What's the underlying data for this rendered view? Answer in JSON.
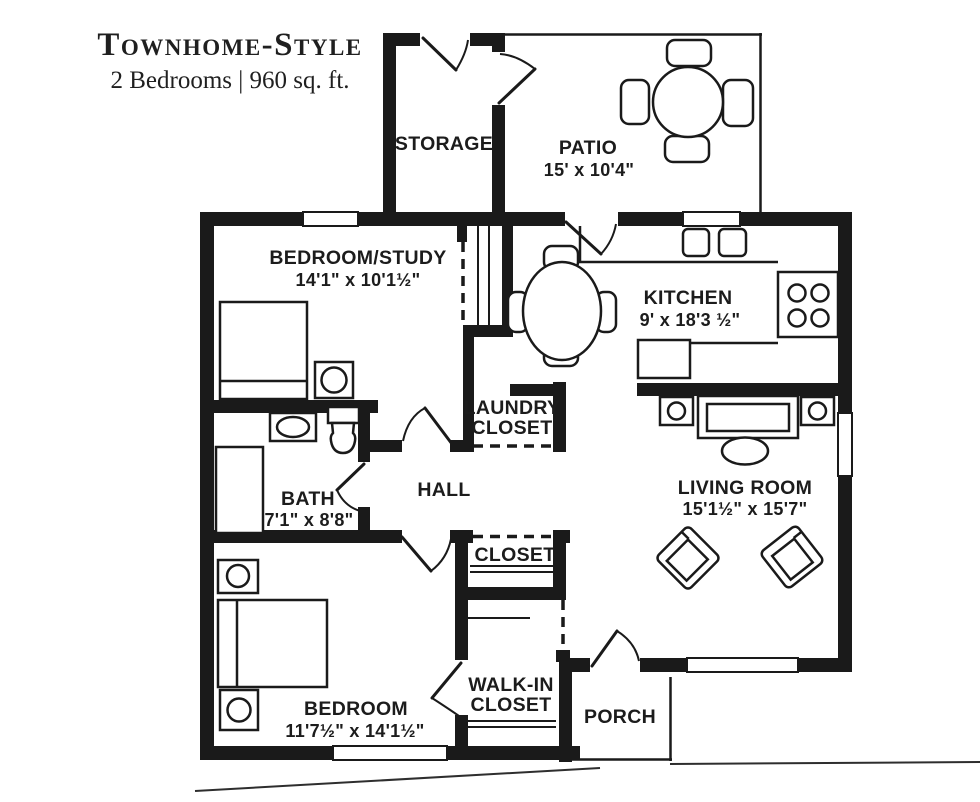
{
  "title": {
    "line1": "Townhome-Style",
    "line2": "2 Bedrooms | 960 sq. ft."
  },
  "rooms": {
    "storage": {
      "label": "STORAGE"
    },
    "patio": {
      "label": "PATIO",
      "dims": "15' x 10'4\""
    },
    "bedroom_study": {
      "label": "BEDROOM/STUDY",
      "dims": "14'1\" x 10'1½\""
    },
    "kitchen": {
      "label": "KITCHEN",
      "dims": "9' x 18'3 ½\""
    },
    "laundry_closet": {
      "label_line1": "LAUNDRY",
      "label_line2": "CLOSET"
    },
    "hall": {
      "label": "HALL"
    },
    "bath": {
      "label": "BATH",
      "dims": "7'1\" x 8'8\""
    },
    "closet": {
      "label": "CLOSET"
    },
    "living_room": {
      "label": "LIVING ROOM",
      "dims": "15'1½\" x 15'7\""
    },
    "walk_in_closet": {
      "label_line1": "WALK-IN",
      "label_line2": "CLOSET"
    },
    "bedroom": {
      "label": "BEDROOM",
      "dims": "11'7½\" x 14'1½\""
    },
    "porch": {
      "label": "PORCH"
    }
  },
  "colors": {
    "wall": "#1a1a1a",
    "background": "#ffffff",
    "text": "#1c1c1c"
  }
}
